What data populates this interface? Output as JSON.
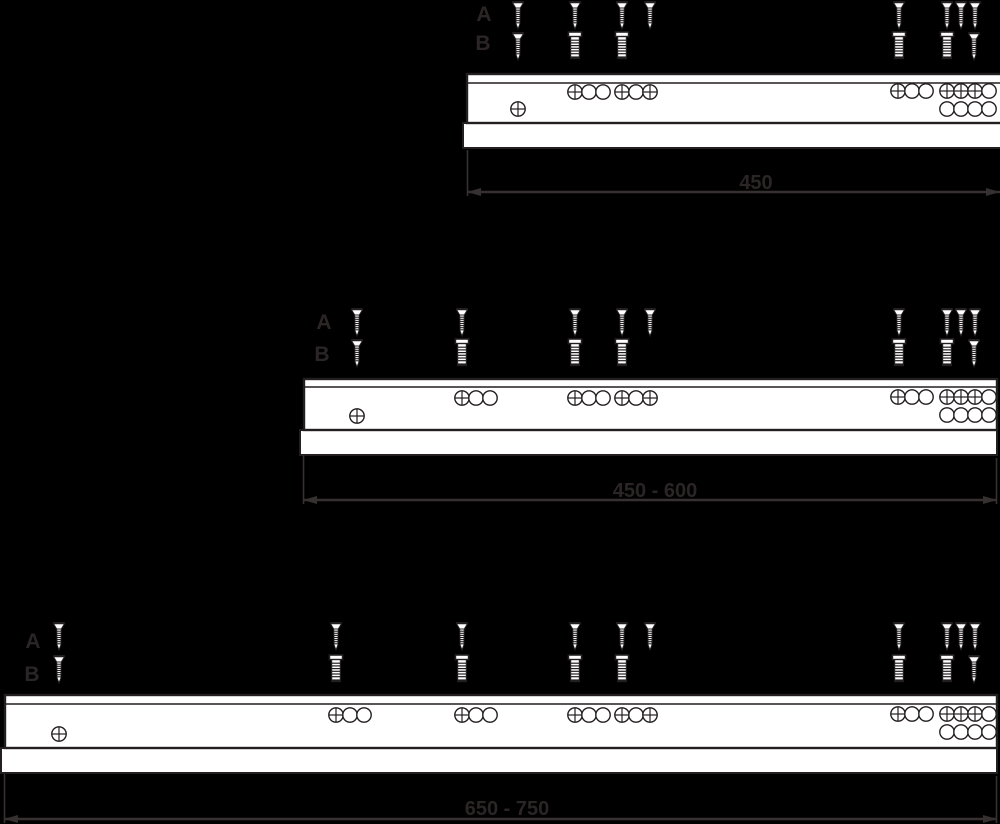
{
  "figure": {
    "type": "technical-diagram",
    "description": "Drawer slide rails with screw mounting positions, rows A and B, for three length ranges",
    "row_labels": {
      "a": "A",
      "b": "B"
    }
  },
  "colors": {
    "background": "#000000",
    "rail_fill": "#ffffff",
    "line_ink": "#231f20",
    "dim_line": "#363031",
    "dim_text": "#2b2526"
  },
  "geometry": {
    "hole_radius": 7.2,
    "hole_spacing": 14
  },
  "rails": [
    {
      "id": "450",
      "dimension_label": "450",
      "row_label_a": {
        "text": "A",
        "x": 484,
        "y": 21
      },
      "row_label_b": {
        "text": "B",
        "x": 483,
        "y": 50
      },
      "body": {
        "upper": {
          "x1": 467,
          "y1": 74,
          "x2": 1004,
          "y2": 123
        },
        "lip_y": 83,
        "lower": {
          "x1": 463,
          "y1": 123,
          "x2": 1004,
          "y2": 148
        }
      },
      "screws_a": {
        "y": 1,
        "x": [
          518,
          575,
          622,
          650,
          899,
          947,
          961,
          975
        ]
      },
      "screws_b": {
        "y": 32,
        "items": [
          {
            "x": 518,
            "type": "countersunk"
          },
          {
            "x": 575,
            "type": "pan"
          },
          {
            "x": 622,
            "type": "pan"
          },
          {
            "x": 899,
            "type": "pan"
          },
          {
            "x": 947,
            "type": "pan"
          },
          {
            "x": 974,
            "type": "countersunk"
          }
        ]
      },
      "hole_groups": [
        {
          "x": 575,
          "y": 92,
          "pattern": "xoo"
        },
        {
          "x": 622,
          "y": 92,
          "pattern": "xox"
        },
        {
          "x": 898,
          "y": 91,
          "pattern": "xoo"
        },
        {
          "x": 947,
          "y": 91,
          "pattern": "xxxo"
        },
        {
          "x": 518,
          "y": 109,
          "pattern": "x"
        },
        {
          "x": 947,
          "y": 109,
          "pattern": "oooo"
        }
      ],
      "dimension": {
        "y": 192,
        "x1": 467,
        "x2": 1000,
        "arrow_left": true,
        "arrow_right": true,
        "label_x": 756,
        "label_y": 189,
        "extensions": [
          {
            "x": 467.5,
            "y1": 150,
            "y2": 196
          }
        ]
      }
    },
    {
      "id": "450-600",
      "dimension_label": "450 - 600",
      "row_label_a": {
        "text": "A",
        "x": 324,
        "y": 329
      },
      "row_label_b": {
        "text": "B",
        "x": 322,
        "y": 361
      },
      "body": {
        "upper": {
          "x1": 304,
          "y1": 379,
          "x2": 997,
          "y2": 430
        },
        "lip_y": 387,
        "lower": {
          "x1": 300,
          "y1": 430,
          "x2": 997,
          "y2": 455
        }
      },
      "screws_a": {
        "y": 308,
        "x": [
          357,
          462,
          575,
          622,
          650,
          899,
          947,
          961,
          975
        ]
      },
      "screws_b": {
        "y": 339,
        "items": [
          {
            "x": 357,
            "type": "countersunk"
          },
          {
            "x": 462,
            "type": "pan"
          },
          {
            "x": 575,
            "type": "pan"
          },
          {
            "x": 622,
            "type": "pan"
          },
          {
            "x": 899,
            "type": "pan"
          },
          {
            "x": 947,
            "type": "pan"
          },
          {
            "x": 974,
            "type": "countersunk"
          }
        ]
      },
      "hole_groups": [
        {
          "x": 462,
          "y": 398,
          "pattern": "xoo"
        },
        {
          "x": 575,
          "y": 398,
          "pattern": "xoo"
        },
        {
          "x": 622,
          "y": 398,
          "pattern": "xox"
        },
        {
          "x": 898,
          "y": 397,
          "pattern": "xoo"
        },
        {
          "x": 947,
          "y": 397,
          "pattern": "xxxo"
        },
        {
          "x": 357,
          "y": 416,
          "pattern": "x"
        },
        {
          "x": 947,
          "y": 415,
          "pattern": "oooo"
        }
      ],
      "dimension": {
        "y": 500,
        "x1": 303,
        "x2": 997,
        "arrow_left": true,
        "arrow_right": true,
        "label_x": 655,
        "label_y": 497,
        "extensions": [
          {
            "x": 303.5,
            "y1": 455,
            "y2": 504
          },
          {
            "x": 996.5,
            "y1": 458,
            "y2": 504
          }
        ]
      }
    },
    {
      "id": "650-750",
      "dimension_label": "650 - 750",
      "row_label_a": {
        "text": "A",
        "x": 33,
        "y": 648
      },
      "row_label_b": {
        "text": "B",
        "x": 32,
        "y": 681
      },
      "body": {
        "upper": {
          "x1": 5,
          "y1": 695,
          "x2": 997,
          "y2": 748
        },
        "lip_y": 704,
        "lower": {
          "x1": 1,
          "y1": 748,
          "x2": 997,
          "y2": 773
        }
      },
      "screws_a": {
        "y": 622,
        "x": [
          59,
          336,
          462,
          575,
          622,
          650,
          899,
          947,
          961,
          975
        ]
      },
      "screws_b": {
        "y": 655,
        "items": [
          {
            "x": 59,
            "type": "countersunk"
          },
          {
            "x": 336,
            "type": "pan"
          },
          {
            "x": 462,
            "type": "pan"
          },
          {
            "x": 575,
            "type": "pan"
          },
          {
            "x": 622,
            "type": "pan"
          },
          {
            "x": 899,
            "type": "pan"
          },
          {
            "x": 947,
            "type": "pan"
          },
          {
            "x": 974,
            "type": "countersunk"
          }
        ]
      },
      "hole_groups": [
        {
          "x": 336,
          "y": 715,
          "pattern": "xoo"
        },
        {
          "x": 462,
          "y": 715,
          "pattern": "xoo"
        },
        {
          "x": 575,
          "y": 715,
          "pattern": "xoo"
        },
        {
          "x": 622,
          "y": 715,
          "pattern": "xox"
        },
        {
          "x": 898,
          "y": 714,
          "pattern": "xoo"
        },
        {
          "x": 947,
          "y": 714,
          "pattern": "xxxo"
        },
        {
          "x": 59,
          "y": 734,
          "pattern": "x"
        },
        {
          "x": 947,
          "y": 732,
          "pattern": "oooo"
        }
      ],
      "dimension": {
        "y": 819,
        "x1": 4,
        "x2": 997,
        "arrow_left": true,
        "arrow_right": true,
        "label_x": 507,
        "label_y": 815,
        "extensions": [
          {
            "x": 4.5,
            "y1": 774,
            "y2": 823
          },
          {
            "x": 996.5,
            "y1": 776,
            "y2": 823
          }
        ]
      }
    }
  ]
}
